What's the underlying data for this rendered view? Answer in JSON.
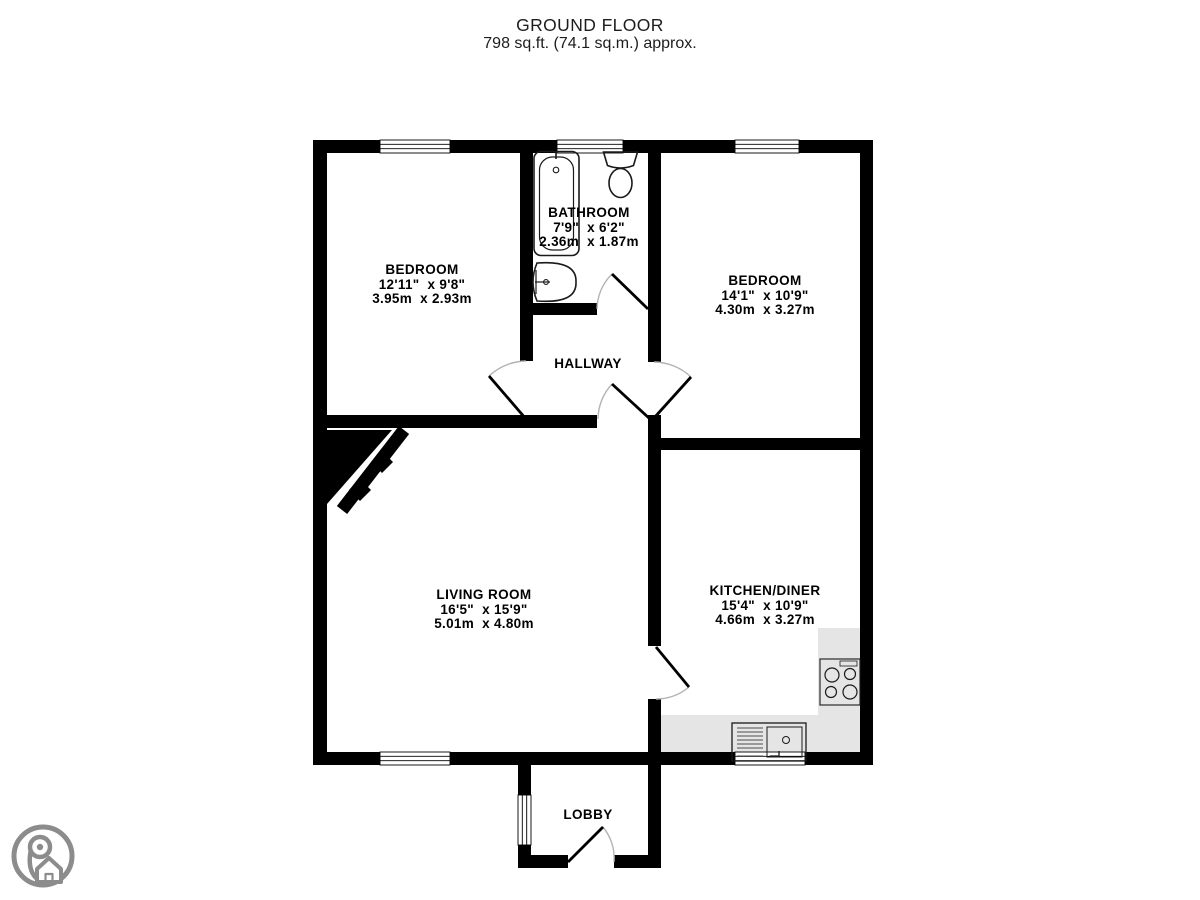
{
  "title": {
    "line1": "GROUND FLOOR",
    "line2": "798 sq.ft. (74.1 sq.m.) approx."
  },
  "rooms": [
    {
      "id": "bedroom-1",
      "name": "BEDROOM",
      "imperial": "12'11\"  x 9'8\"",
      "metric": "3.95m  x 2.93m"
    },
    {
      "id": "bathroom",
      "name": "BATHROOM",
      "imperial": "7'9\"  x 6'2\"",
      "metric": "2.36m  x 1.87m"
    },
    {
      "id": "bedroom-2",
      "name": "BEDROOM",
      "imperial": "14'1\"  x 10'9\"",
      "metric": "4.30m  x 3.27m"
    },
    {
      "id": "hallway",
      "name": "HALLWAY",
      "imperial": "",
      "metric": ""
    },
    {
      "id": "living-room",
      "name": "LIVING ROOM",
      "imperial": "16'5\"  x 15'9\"",
      "metric": "5.01m  x 4.80m"
    },
    {
      "id": "kitchen-diner",
      "name": "KITCHEN/DINER",
      "imperial": "15'4\"  x 10'9\"",
      "metric": "4.66m  x 3.27m"
    },
    {
      "id": "lobby",
      "name": "LOBBY",
      "imperial": "",
      "metric": ""
    }
  ],
  "fixtures": {
    "bathroom": [
      "bathtub-icon",
      "toilet-icon",
      "pedestal-sink-icon"
    ],
    "kitchen": [
      "hob-icon",
      "kitchen-sink-drainer-icon",
      "worktop-counter"
    ],
    "living_room": [
      "fireplace-icon"
    ],
    "logo": "map-pin-house-logo"
  },
  "colors": {
    "wall": "#000000",
    "counter": "#e5e5e5",
    "door_arc": "#b3b3b3",
    "logo": "#8c8c8c"
  }
}
